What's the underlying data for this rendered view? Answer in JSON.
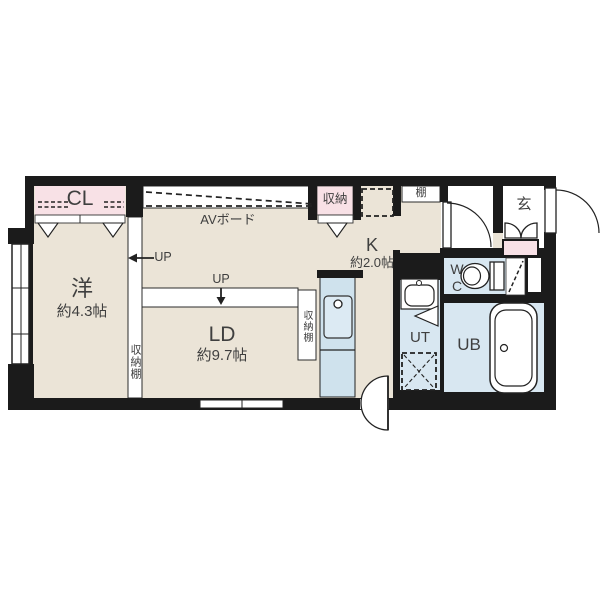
{
  "plan": {
    "rooms": {
      "closet": {
        "label": "CL"
      },
      "western": {
        "label": "洋",
        "size": "約4.3帖"
      },
      "living": {
        "label": "LD",
        "size": "約9.7帖"
      },
      "kitchen": {
        "label": "K",
        "size": "約2.0帖"
      },
      "storage": {
        "label": "収納"
      },
      "shelf": {
        "label": "棚"
      },
      "entrance": {
        "label": "玄"
      },
      "toilet": {
        "label": "WC"
      },
      "utility": {
        "label": "UT"
      },
      "bath": {
        "label": "UB"
      }
    },
    "features": {
      "av_board": "AVボード",
      "storage_shelf": "収納棚",
      "up": "UP"
    },
    "colors": {
      "floor": "#ebe4d7",
      "closet": "#f8e1e6",
      "wet_area": "#d8e7f1",
      "wall": "#1b1b1b",
      "text": "#3f3f3f"
    }
  }
}
